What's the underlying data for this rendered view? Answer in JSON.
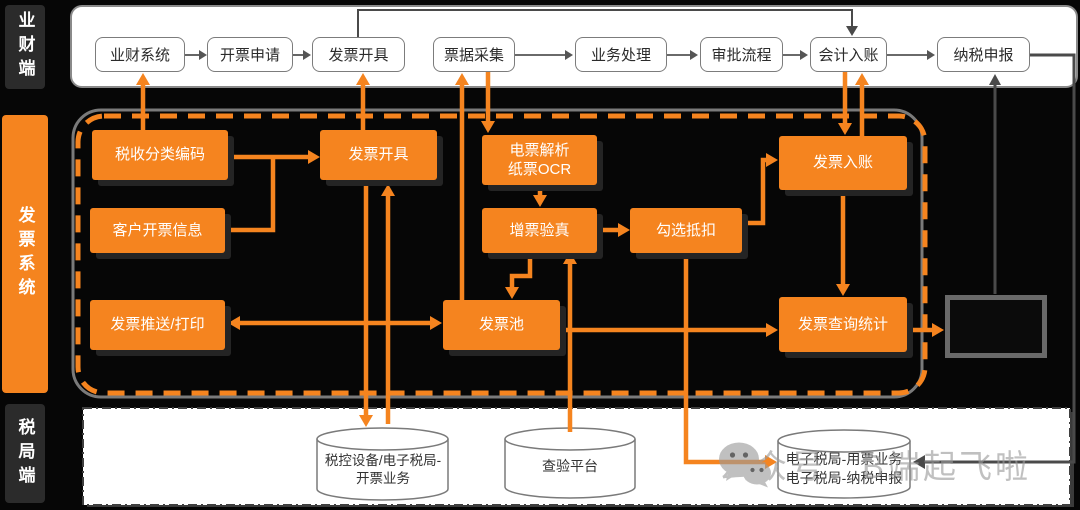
{
  "lanes": {
    "business_finance": "业财端",
    "invoice_system": "发票系统",
    "tax_bureau": "税局端"
  },
  "top_flow": {
    "boxes": [
      {
        "label": "业财系统"
      },
      {
        "label": "开票申请"
      },
      {
        "label": "发票开具"
      },
      {
        "label": "票据采集"
      },
      {
        "label": "业务处理"
      },
      {
        "label": "审批流程"
      },
      {
        "label": "会计入账"
      },
      {
        "label": "纳税申报"
      }
    ]
  },
  "middle": {
    "tax_code": "税收分类编码",
    "customer_info": "客户开票信息",
    "invoice_issue": "发票开具",
    "eticket_parse_line1": "电票解析",
    "eticket_parse_line2": "纸票OCR",
    "vat_verify": "增票验真",
    "deduction": "勾选抵扣",
    "invoice_entry": "发票入账",
    "push_print": "发票推送/打印",
    "invoice_pool": "发票池",
    "query_stats": "发票查询统计"
  },
  "bottom_row": {
    "cyl1_line1": "税控设备/电子税局-",
    "cyl1_line2": "开票业务",
    "cyl2": "查验平台",
    "cyl3_line1": "电子税局-用票业务",
    "cyl3_line2": "电子税局-纳税申报"
  },
  "watermark": {
    "text": "公众号：B端起飞啦"
  },
  "colors": {
    "accent": "#F5841F",
    "line_gray": "#4a4a4a",
    "lane_dark": "#2b2b2b"
  }
}
